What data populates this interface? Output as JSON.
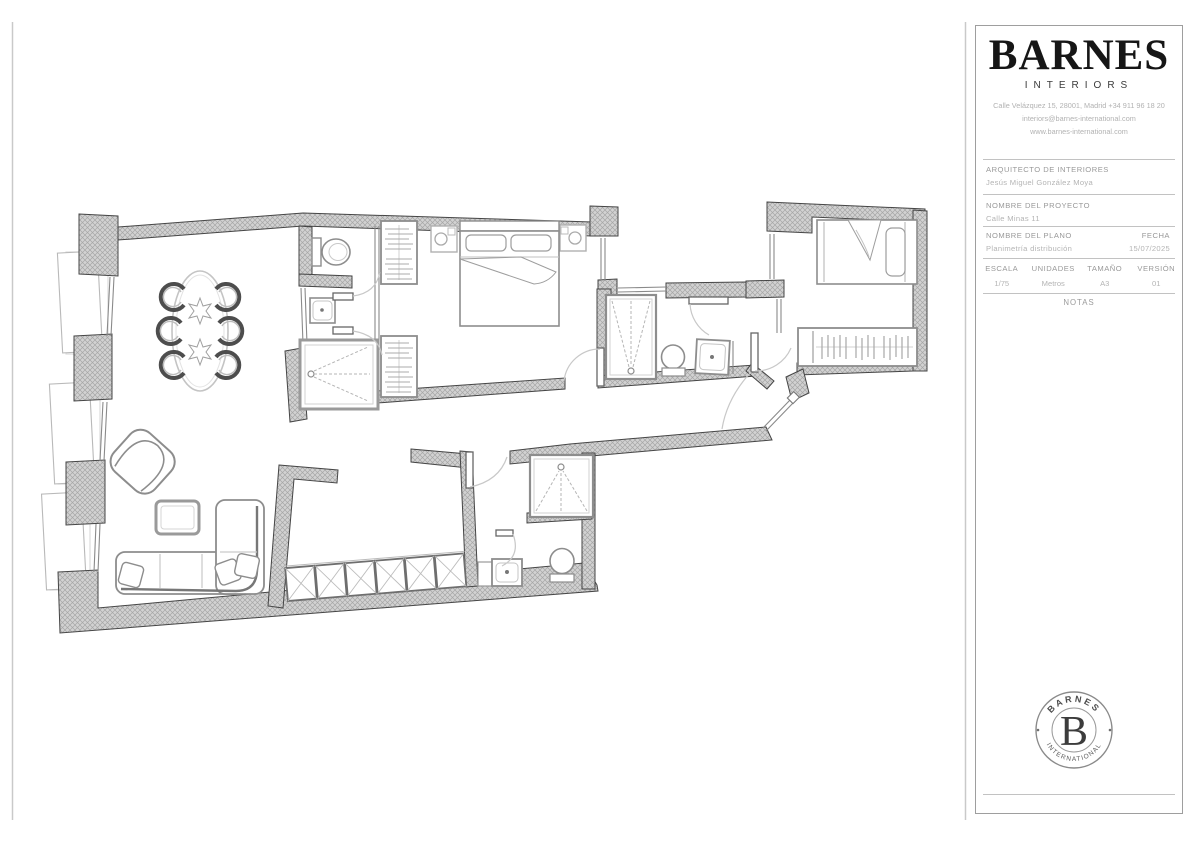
{
  "title_block": {
    "brand": "BARNES",
    "brand_subtitle": "INTERIORS",
    "address_line1": "Calle Velázquez 15, 28001, Madrid +34 911 96 18 20",
    "address_line2": "interiors@barnes-international.com",
    "address_line3": "www.barnes-international.com",
    "architect": {
      "label": "ARQUITECTO DE INTERIORES",
      "value": "Jesús Miguel González Moya"
    },
    "project": {
      "label": "NOMBRE DEL PROYECTO",
      "value": "Calle Minas 11"
    },
    "plan": {
      "label": "NOMBRE DEL PLANO",
      "value": "Planimetría distribución"
    },
    "date": {
      "label": "FECHA",
      "value": "15/07/2025"
    },
    "scale": {
      "label": "ESCALA",
      "value": "1/75"
    },
    "units": {
      "label": "UNIDADES",
      "value": "Metros"
    },
    "size": {
      "label": "TAMAÑO",
      "value": "A3"
    },
    "version": {
      "label": "VERSIÓN",
      "value": "01"
    },
    "notes_label": "NOTAS"
  },
  "stamp": {
    "arc_top": "BARNES",
    "monogram": "B",
    "arc_bottom": "INTERNATIONAL"
  }
}
